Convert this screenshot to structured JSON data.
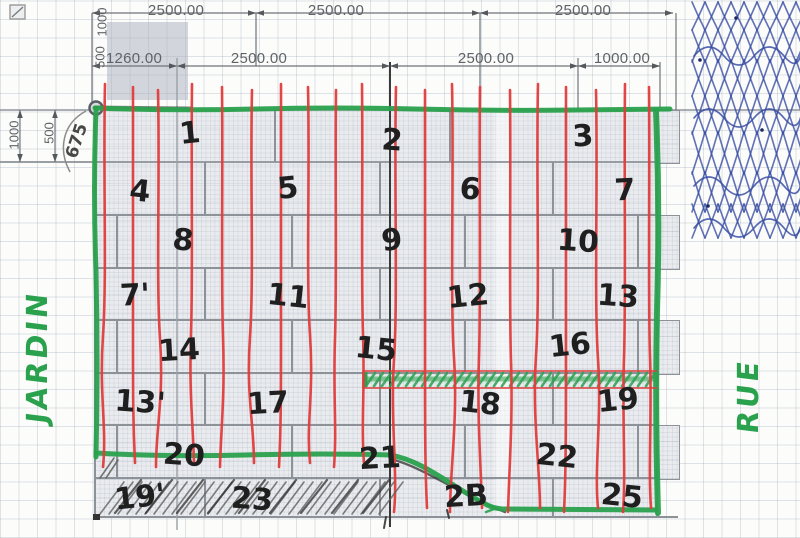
{
  "drawing": {
    "dim_rows": {
      "row1": {
        "labels": [
          {
            "text": "2500.00",
            "cx": 176
          },
          {
            "text": "2500.00",
            "cx": 336
          },
          {
            "text": "2500.00",
            "cx": 583
          }
        ]
      },
      "row2": {
        "labels": [
          {
            "text": "1260.00",
            "cx": 134
          },
          {
            "text": "2500.00",
            "cx": 259
          },
          {
            "text": "2500.00",
            "cx": 486
          },
          {
            "text": "1000.00",
            "cx": 622
          }
        ]
      }
    },
    "left_dim_labels": [
      {
        "text": "1000",
        "x": 14,
        "y": 135
      },
      {
        "text": "500",
        "x": 49,
        "y": 133
      }
    ],
    "corner_rotated_labels": [
      {
        "text": "1000",
        "x": 102,
        "y": 22
      },
      {
        "text": "500",
        "x": 100,
        "y": 57
      }
    ],
    "pencil_dim": {
      "text": "675",
      "x": 77,
      "y": 141
    },
    "zone_labels": {
      "left": "JARDIN",
      "right": "RUE"
    },
    "panel_numbers": [
      {
        "text": "1",
        "x": 190,
        "y": 134
      },
      {
        "text": "2",
        "x": 392,
        "y": 141
      },
      {
        "text": "3",
        "x": 583,
        "y": 137
      },
      {
        "text": "4",
        "x": 140,
        "y": 192
      },
      {
        "text": "5",
        "x": 288,
        "y": 189
      },
      {
        "text": "6",
        "x": 470,
        "y": 190
      },
      {
        "text": "7",
        "x": 625,
        "y": 191
      },
      {
        "text": "8",
        "x": 183,
        "y": 241
      },
      {
        "text": "9",
        "x": 392,
        "y": 241
      },
      {
        "text": "10",
        "x": 578,
        "y": 242
      },
      {
        "text": "7'",
        "x": 135,
        "y": 296
      },
      {
        "text": "11",
        "x": 288,
        "y": 297
      },
      {
        "text": "12",
        "x": 468,
        "y": 297
      },
      {
        "text": "13",
        "x": 618,
        "y": 297
      },
      {
        "text": "14",
        "x": 179,
        "y": 351
      },
      {
        "text": "15",
        "x": 376,
        "y": 350
      },
      {
        "text": "16",
        "x": 570,
        "y": 346
      },
      {
        "text": "13'",
        "x": 140,
        "y": 403
      },
      {
        "text": "17",
        "x": 268,
        "y": 404
      },
      {
        "text": "18",
        "x": 480,
        "y": 404
      },
      {
        "text": "19",
        "x": 618,
        "y": 401
      },
      {
        "text": "20",
        "x": 184,
        "y": 456
      },
      {
        "text": "21",
        "x": 380,
        "y": 459
      },
      {
        "text": "22",
        "x": 557,
        "y": 457
      },
      {
        "text": "19'",
        "x": 140,
        "y": 498
      },
      {
        "text": "23",
        "x": 252,
        "y": 500
      },
      {
        "text": "2B",
        "x": 466,
        "y": 497
      },
      {
        "text": "25",
        "x": 622,
        "y": 497
      }
    ],
    "colors": {
      "marker_green": "#2aa14d",
      "marker_red": "#e03c3c",
      "pen_blue": "#3a4fa5",
      "pencil_gray": "#555555",
      "cad_text": "#5f6368",
      "handwriting_black": "#1f1f1f"
    }
  }
}
